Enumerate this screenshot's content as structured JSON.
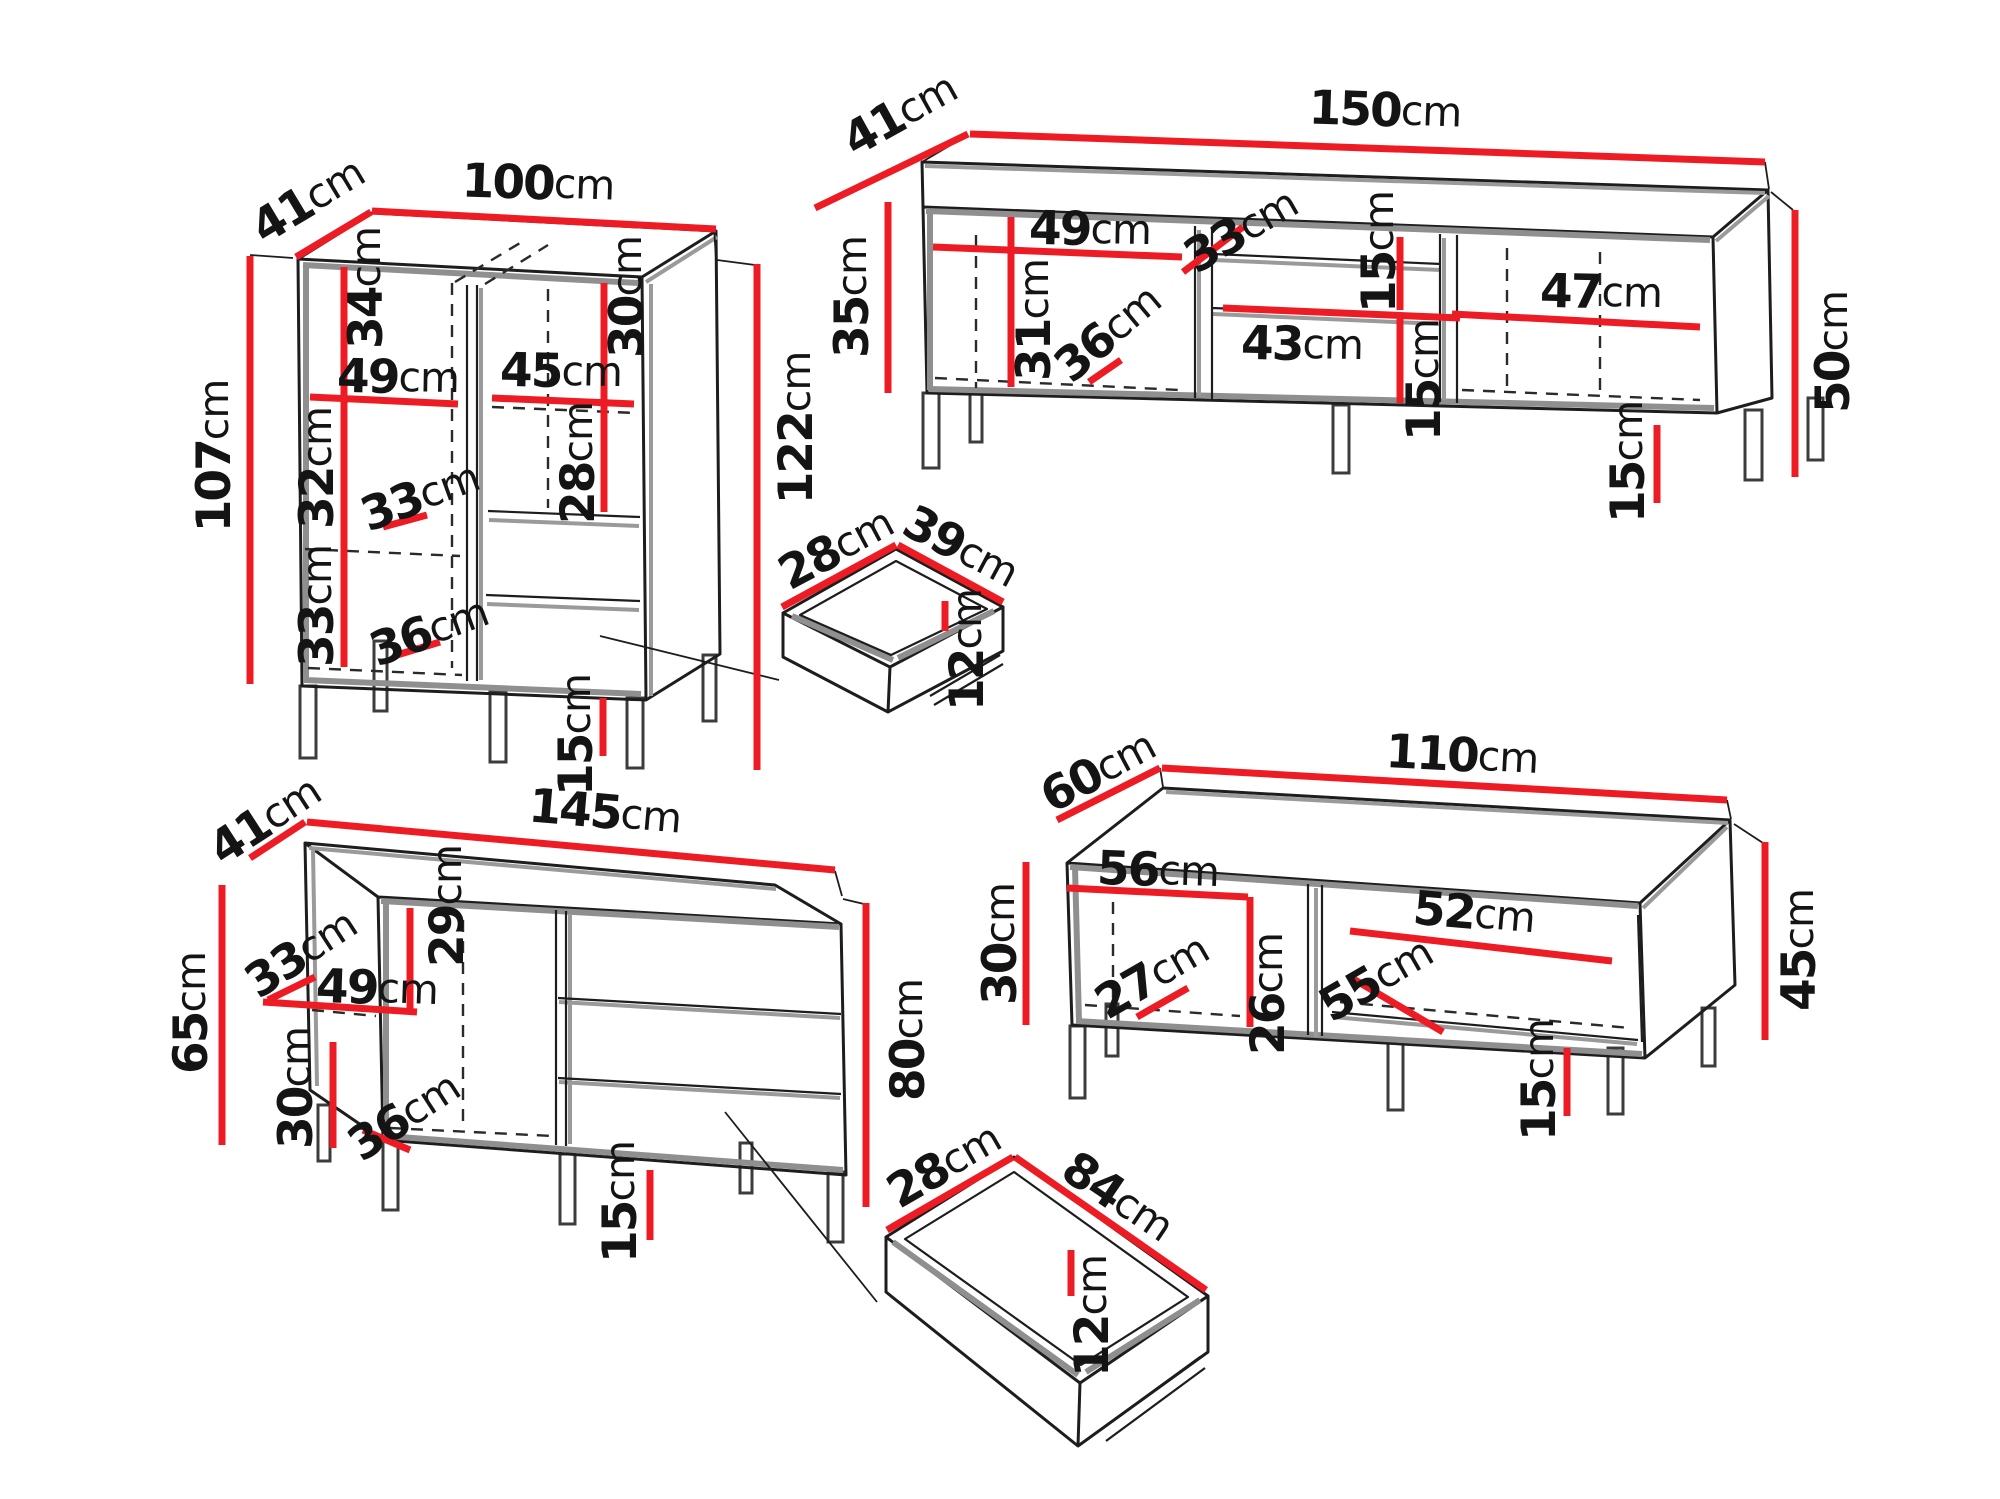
{
  "colors": {
    "dimension_red": "#ed1c24",
    "outline_black": "#1d1d1d",
    "shading_gray": "#8f8f8f",
    "background": "#ffffff"
  },
  "unit": "cm",
  "pieces": {
    "cabinet": {
      "labels": {
        "depth": {
          "v": "41",
          "u": "cm"
        },
        "width": {
          "v": "100",
          "u": "cm"
        },
        "height_left": {
          "v": "107",
          "u": "cm"
        },
        "height_right": {
          "v": "122",
          "u": "cm"
        },
        "top_section_left": {
          "v": "34",
          "u": "cm"
        },
        "top_section_right": {
          "v": "30",
          "u": "cm"
        },
        "shelf_left": {
          "v": "49",
          "u": "cm"
        },
        "shelf_right": {
          "v": "45",
          "u": "cm"
        },
        "middle_section_left": {
          "v": "32",
          "u": "cm"
        },
        "door_width_top": {
          "v": "33",
          "u": "cm"
        },
        "middle_section_right": {
          "v": "28",
          "u": "cm"
        },
        "bottom_section_left": {
          "v": "33",
          "u": "cm"
        },
        "door_width_bottom": {
          "v": "36",
          "u": "cm"
        },
        "legs": {
          "v": "15",
          "u": "cm"
        }
      }
    },
    "tv_stand": {
      "labels": {
        "depth": {
          "v": "41",
          "u": "cm"
        },
        "width": {
          "v": "150",
          "u": "cm"
        },
        "body_height": {
          "v": "35",
          "u": "cm"
        },
        "total_height": {
          "v": "50",
          "u": "cm"
        },
        "shelf_left": {
          "v": "49",
          "u": "cm"
        },
        "section_left": {
          "v": "31",
          "u": "cm"
        },
        "door_width_left": {
          "v": "36",
          "u": "cm"
        },
        "door_width_middle": {
          "v": "33",
          "u": "cm"
        },
        "niche_top": {
          "v": "15",
          "u": "cm"
        },
        "shelf_middle": {
          "v": "43",
          "u": "cm"
        },
        "niche_bottom": {
          "v": "15",
          "u": "cm"
        },
        "shelf_right": {
          "v": "47",
          "u": "cm"
        },
        "legs": {
          "v": "15",
          "u": "cm"
        }
      }
    },
    "drawer_small": {
      "labels": {
        "width": {
          "v": "28",
          "u": "cm"
        },
        "length": {
          "v": "39",
          "u": "cm"
        },
        "height": {
          "v": "12",
          "u": "cm"
        }
      }
    },
    "sideboard": {
      "labels": {
        "depth": {
          "v": "41",
          "u": "cm"
        },
        "width": {
          "v": "145",
          "u": "cm"
        },
        "body_height": {
          "v": "65",
          "u": "cm"
        },
        "total_height": {
          "v": "80",
          "u": "cm"
        },
        "top_section": {
          "v": "29",
          "u": "cm"
        },
        "door_width_top": {
          "v": "33",
          "u": "cm"
        },
        "shelf": {
          "v": "49",
          "u": "cm"
        },
        "bottom_section": {
          "v": "30",
          "u": "cm"
        },
        "door_width_bottom": {
          "v": "36",
          "u": "cm"
        },
        "legs": {
          "v": "15",
          "u": "cm"
        }
      }
    },
    "bench": {
      "labels": {
        "depth": {
          "v": "60",
          "u": "cm"
        },
        "width": {
          "v": "110",
          "u": "cm"
        },
        "body_height": {
          "v": "30",
          "u": "cm"
        },
        "total_height": {
          "v": "45",
          "u": "cm"
        },
        "shelf_left": {
          "v": "56",
          "u": "cm"
        },
        "door_width_left": {
          "v": "27",
          "u": "cm"
        },
        "section_middle": {
          "v": "26",
          "u": "cm"
        },
        "door_width_right": {
          "v": "55",
          "u": "cm"
        },
        "shelf_right": {
          "v": "52",
          "u": "cm"
        },
        "legs": {
          "v": "15",
          "u": "cm"
        }
      }
    },
    "drawer_large": {
      "labels": {
        "width": {
          "v": "28",
          "u": "cm"
        },
        "length": {
          "v": "84",
          "u": "cm"
        },
        "height": {
          "v": "12",
          "u": "cm"
        }
      }
    }
  }
}
